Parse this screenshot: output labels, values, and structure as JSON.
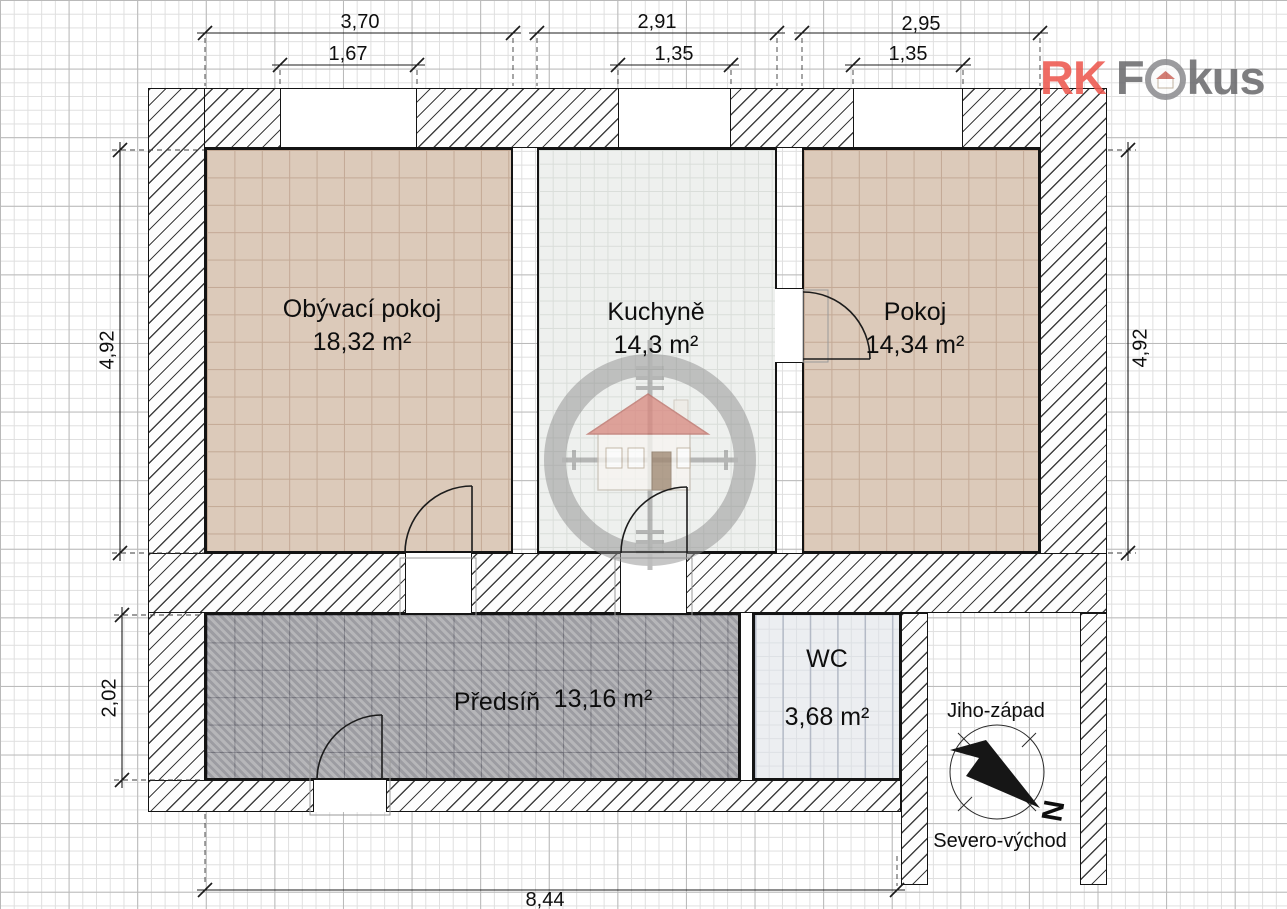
{
  "brand": {
    "rk": "RK",
    "f": "F",
    "kus": "kus"
  },
  "rooms": [
    {
      "id": "obyvaci-pokoj",
      "name": "Obývací pokoj",
      "area": "18,32 m²"
    },
    {
      "id": "kuchyne",
      "name": "Kuchyně",
      "area": "14,3 m²"
    },
    {
      "id": "pokoj",
      "name": "Pokoj",
      "area": "14,34 m²"
    },
    {
      "id": "predsin",
      "name": "Předsíň",
      "area": "13,16 m²"
    },
    {
      "id": "wc",
      "name": "WC",
      "area": "3,68 m²"
    }
  ],
  "dimensions": {
    "top_primary": [
      "3,70",
      "2,91",
      "2,95"
    ],
    "top_secondary": [
      "1,67",
      "1,35",
      "1,35"
    ],
    "left_upper": "4,92",
    "left_lower": "2,02",
    "right_side": "4,92",
    "bottom_total": "8,44"
  },
  "compass": {
    "southwest_label": "Jiho-západ",
    "northeast_label": "Severo-východ",
    "north_letter": "N"
  },
  "icons": {
    "watermark": "house-in-crosshair-icon",
    "brand_o": "house-in-circle-icon",
    "compass": "north-arrow-icon"
  },
  "colors": {
    "accent_red": "#ed574e",
    "logo_gray": "#6b6b6e",
    "tile_tan": "#dccaba",
    "tile_light": "#eef0ee",
    "tile_gray": "#aaaaae",
    "wall_hatch": "#3f3f3f"
  }
}
